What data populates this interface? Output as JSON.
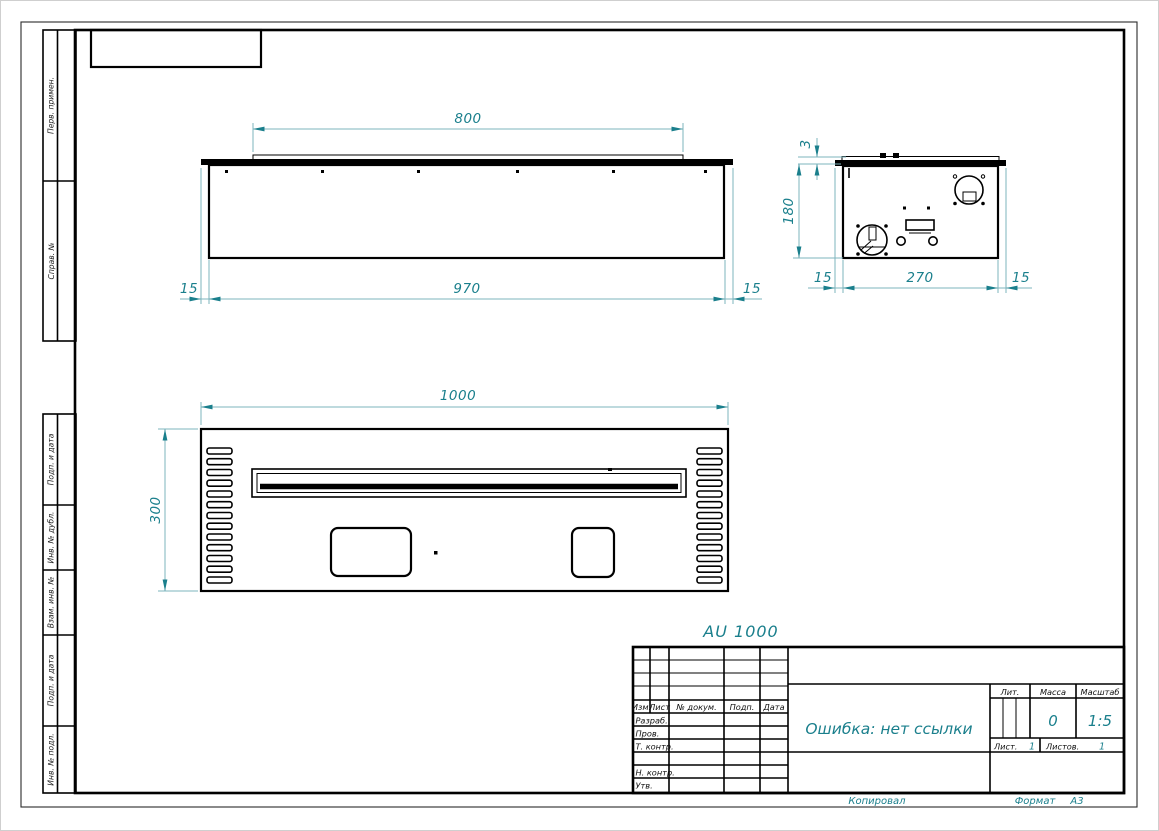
{
  "sheet": {
    "stamp_top": "AU 1000",
    "copied_label": "Копировал",
    "format_label": "Формат",
    "format_value": "А3"
  },
  "margin_labels": [
    "Перв. примен.",
    "Справ. №",
    "Подп. и дата",
    "Инв. № дубл.",
    "Взам. инв. №",
    "Подп. и дата",
    "Инв. № подл."
  ],
  "title_block": {
    "col_izm": "Изм.",
    "col_list": "Лист",
    "col_doc": "№ докум.",
    "col_podp": "Подп.",
    "col_data": "Дата",
    "row_razrab": "Разраб.",
    "row_prov": "Пров.",
    "row_tkontr": "Т. контр.",
    "row_nkontr": "Н. контр.",
    "row_utv": "Утв.",
    "doc_name": "Ошибка: нет ссылки",
    "lit_label": "Лит.",
    "massa_label": "Масса",
    "masshtab_label": "Масштаб",
    "massa_value": "0",
    "masshtab_value": "1:5",
    "list_label": "Лист.",
    "list_value": "1",
    "listov_label": "Листов.",
    "listov_value": "1"
  },
  "dimensions": {
    "front": {
      "top_width": "800",
      "body_width": "970",
      "left_margin": "15",
      "right_margin": "15"
    },
    "side": {
      "plate_thickness": "3",
      "height": "180",
      "left_margin": "15",
      "depth": "270",
      "right_margin": "15"
    },
    "plan": {
      "width": "1000",
      "height": "300"
    }
  },
  "colors": {
    "dim_accent": "#1a7f8c",
    "dim_line": "#7db4bd",
    "drawing_line": "#000000"
  }
}
